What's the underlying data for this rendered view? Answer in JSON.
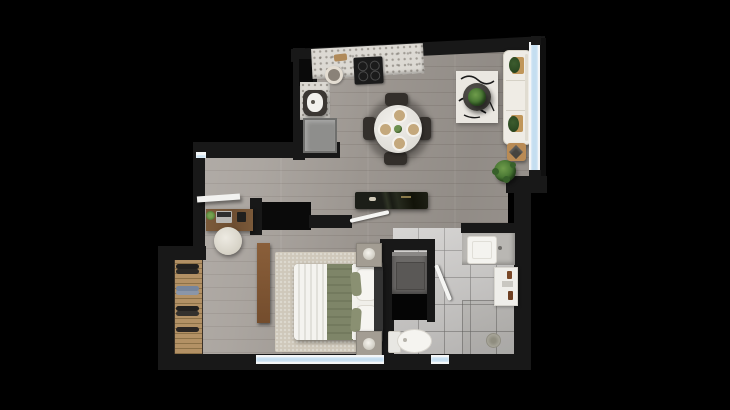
{
  "meta": {
    "title": "Apartment floor plan — rendered top view",
    "view": "top-down 3D render on black background"
  },
  "palette": {
    "background": "#000000",
    "walls": "#181818",
    "wood_floor": "#a29c96",
    "tile_floor": "#c6c4c2",
    "counter_granite": "#dcd9d3",
    "sofa_cream": "#efece5",
    "bedding_green": "#7e8568",
    "furniture_wood": "#8a5f3a",
    "deck_wood": "#b39165",
    "window_glass": "#c4def0",
    "plant_green": "#41702f"
  },
  "rooms": {
    "kitchen": {
      "label": "Kitchen",
      "furniture": [
        "L-shaped granite counter",
        "4-burner cooktop",
        "sink",
        "base unit",
        "tall cabinet niche",
        "cutting board",
        "bowl"
      ]
    },
    "dining": {
      "label": "Dining area",
      "furniture": [
        "round marble table",
        "4 dark chairs",
        "4 place settings",
        "centerpiece plant"
      ]
    },
    "living": {
      "label": "Living room",
      "furniture": [
        "cream 3-seat sofa",
        "patterned rug",
        "round coffee table with plant",
        "wood side table",
        "floor plant",
        "2 armrest trays with plants"
      ]
    },
    "hall": {
      "label": "Hallway",
      "furniture": [
        "dark marble console",
        "white wall shelf"
      ]
    },
    "office": {
      "label": "Work nook",
      "furniture": [
        "wood desk",
        "laptop",
        "desk plant",
        "storage box",
        "round cream chair"
      ]
    },
    "bedroom": {
      "label": "Bedroom",
      "furniture": [
        "double bed with green blanket",
        "2 nightstands with lamps",
        "foot bench",
        "beige rug",
        "dark wardrobe niche"
      ]
    },
    "closet": {
      "label": "Wardrobe strip",
      "furniture": [
        "wood slat floor",
        "hanging clothes on rails"
      ]
    },
    "laundry": {
      "label": "Laundry niche",
      "furniture": [
        "washing machine",
        "black service shaft"
      ]
    },
    "bathroom": {
      "label": "Bathroom",
      "furniture": [
        "vanity with white basin",
        "toilet",
        "walk-in shower with drain",
        "white storage cabinet with bottles"
      ]
    }
  },
  "openings": {
    "windows": [
      "living-room right glazing",
      "bedroom bottom window",
      "bathroom bottom window",
      "hallway top window"
    ],
    "door_leaves": [
      "bedroom door (open)",
      "bathroom door (open)"
    ]
  }
}
